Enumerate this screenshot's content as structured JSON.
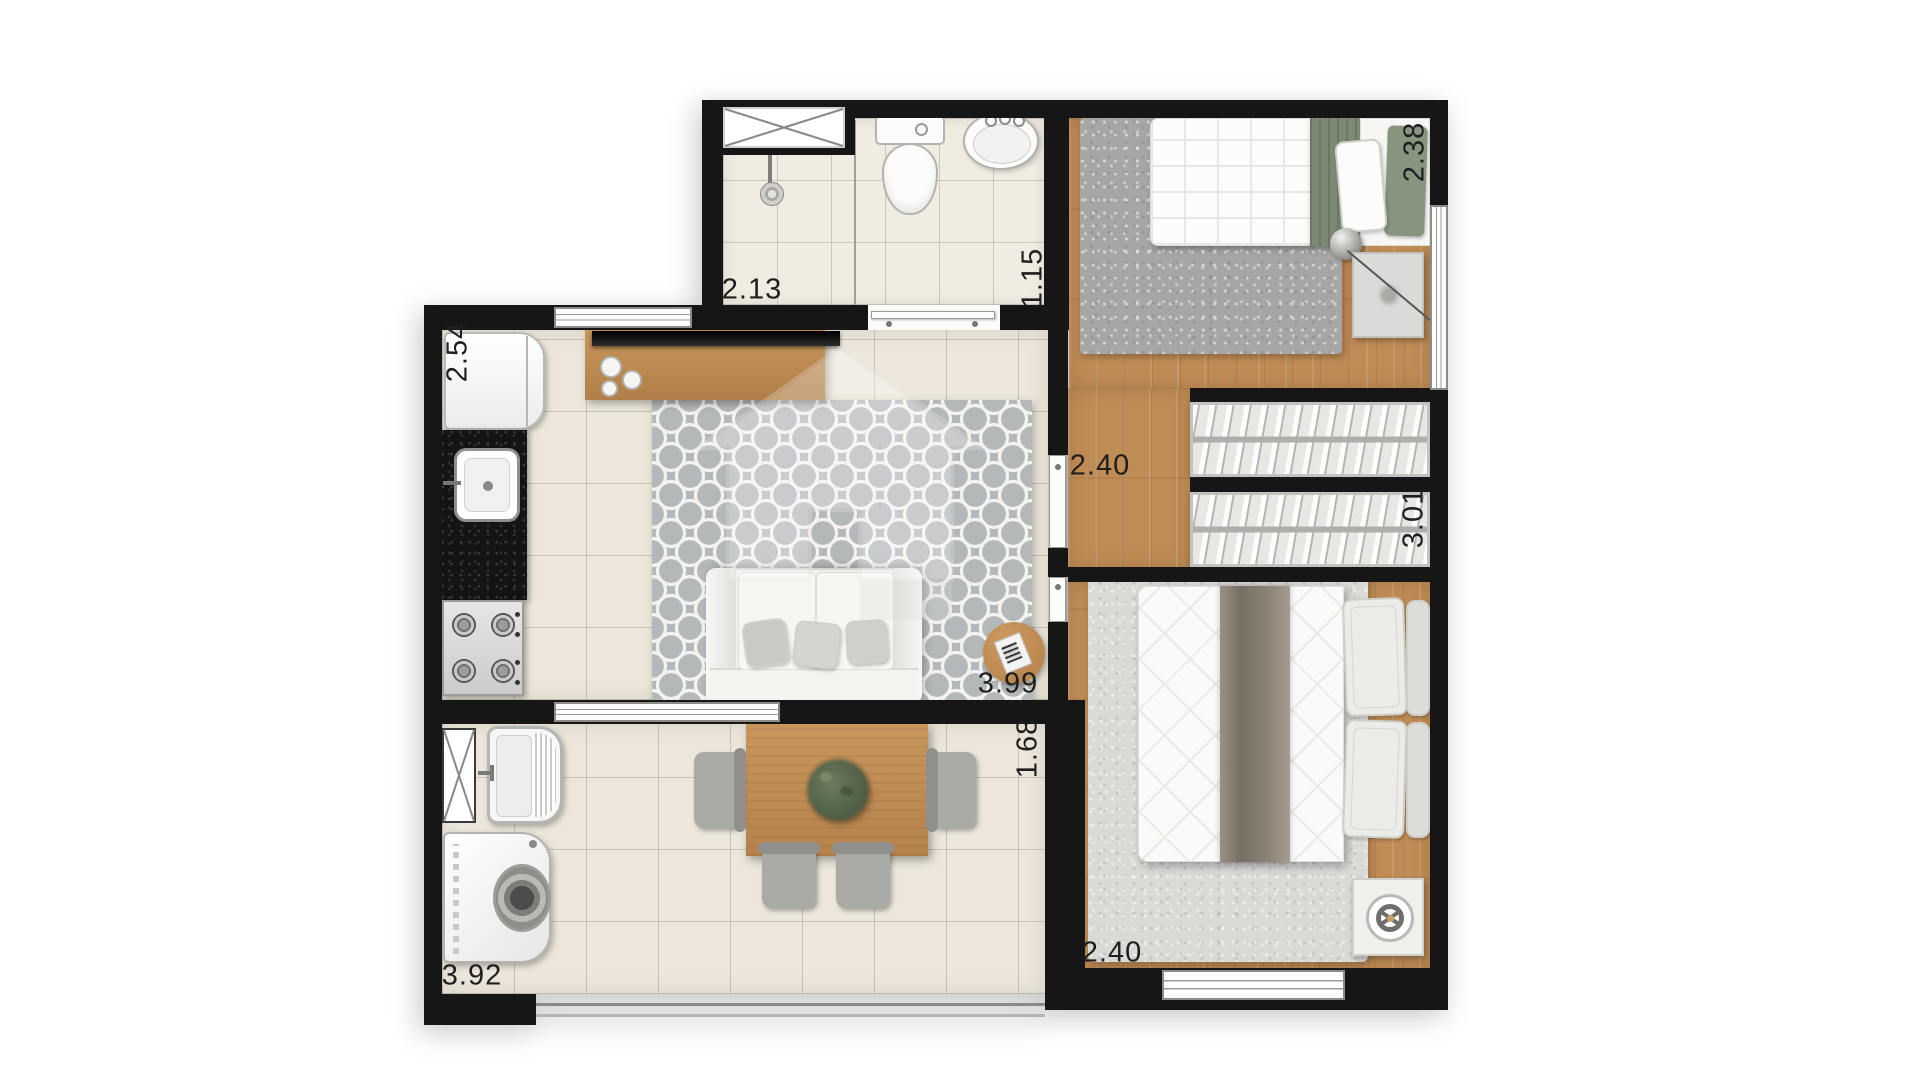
{
  "page": {
    "background": "#ffffff",
    "description_colors": {
      "wall": "#161616",
      "tile_floor": "#ede7db",
      "bath_tile": "#f1ece2",
      "wood_floor": "#c08c55",
      "living_rug": "#b5b8b9",
      "bedroom1_rug": "#a6a6a4",
      "bedroom2_rug": "#dadad7",
      "green_bedding": "#7c8a74",
      "wood_furniture": "#c08b52",
      "granite_counter": "#181818"
    }
  },
  "plan": {
    "type": "apartment-floor-plan",
    "dimension_labels": [
      {
        "id": "kitchen-depth",
        "text": "2.54",
        "orientation": "vertical"
      },
      {
        "id": "bathroom-width",
        "text": "2.13",
        "orientation": "horizontal"
      },
      {
        "id": "bathroom-depth",
        "text": "1.15",
        "orientation": "vertical"
      },
      {
        "id": "bedroom1-width",
        "text": "2.38",
        "orientation": "vertical"
      },
      {
        "id": "hall-width",
        "text": "2.40",
        "orientation": "horizontal"
      },
      {
        "id": "wardrobe-length",
        "text": "3.01",
        "orientation": "vertical"
      },
      {
        "id": "living-length",
        "text": "3.99",
        "orientation": "horizontal"
      },
      {
        "id": "terrace-depth",
        "text": "1.68",
        "orientation": "vertical"
      },
      {
        "id": "bedroom2-width",
        "text": "2.40",
        "orientation": "horizontal"
      },
      {
        "id": "terrace-width",
        "text": "3.92",
        "orientation": "horizontal"
      }
    ]
  }
}
